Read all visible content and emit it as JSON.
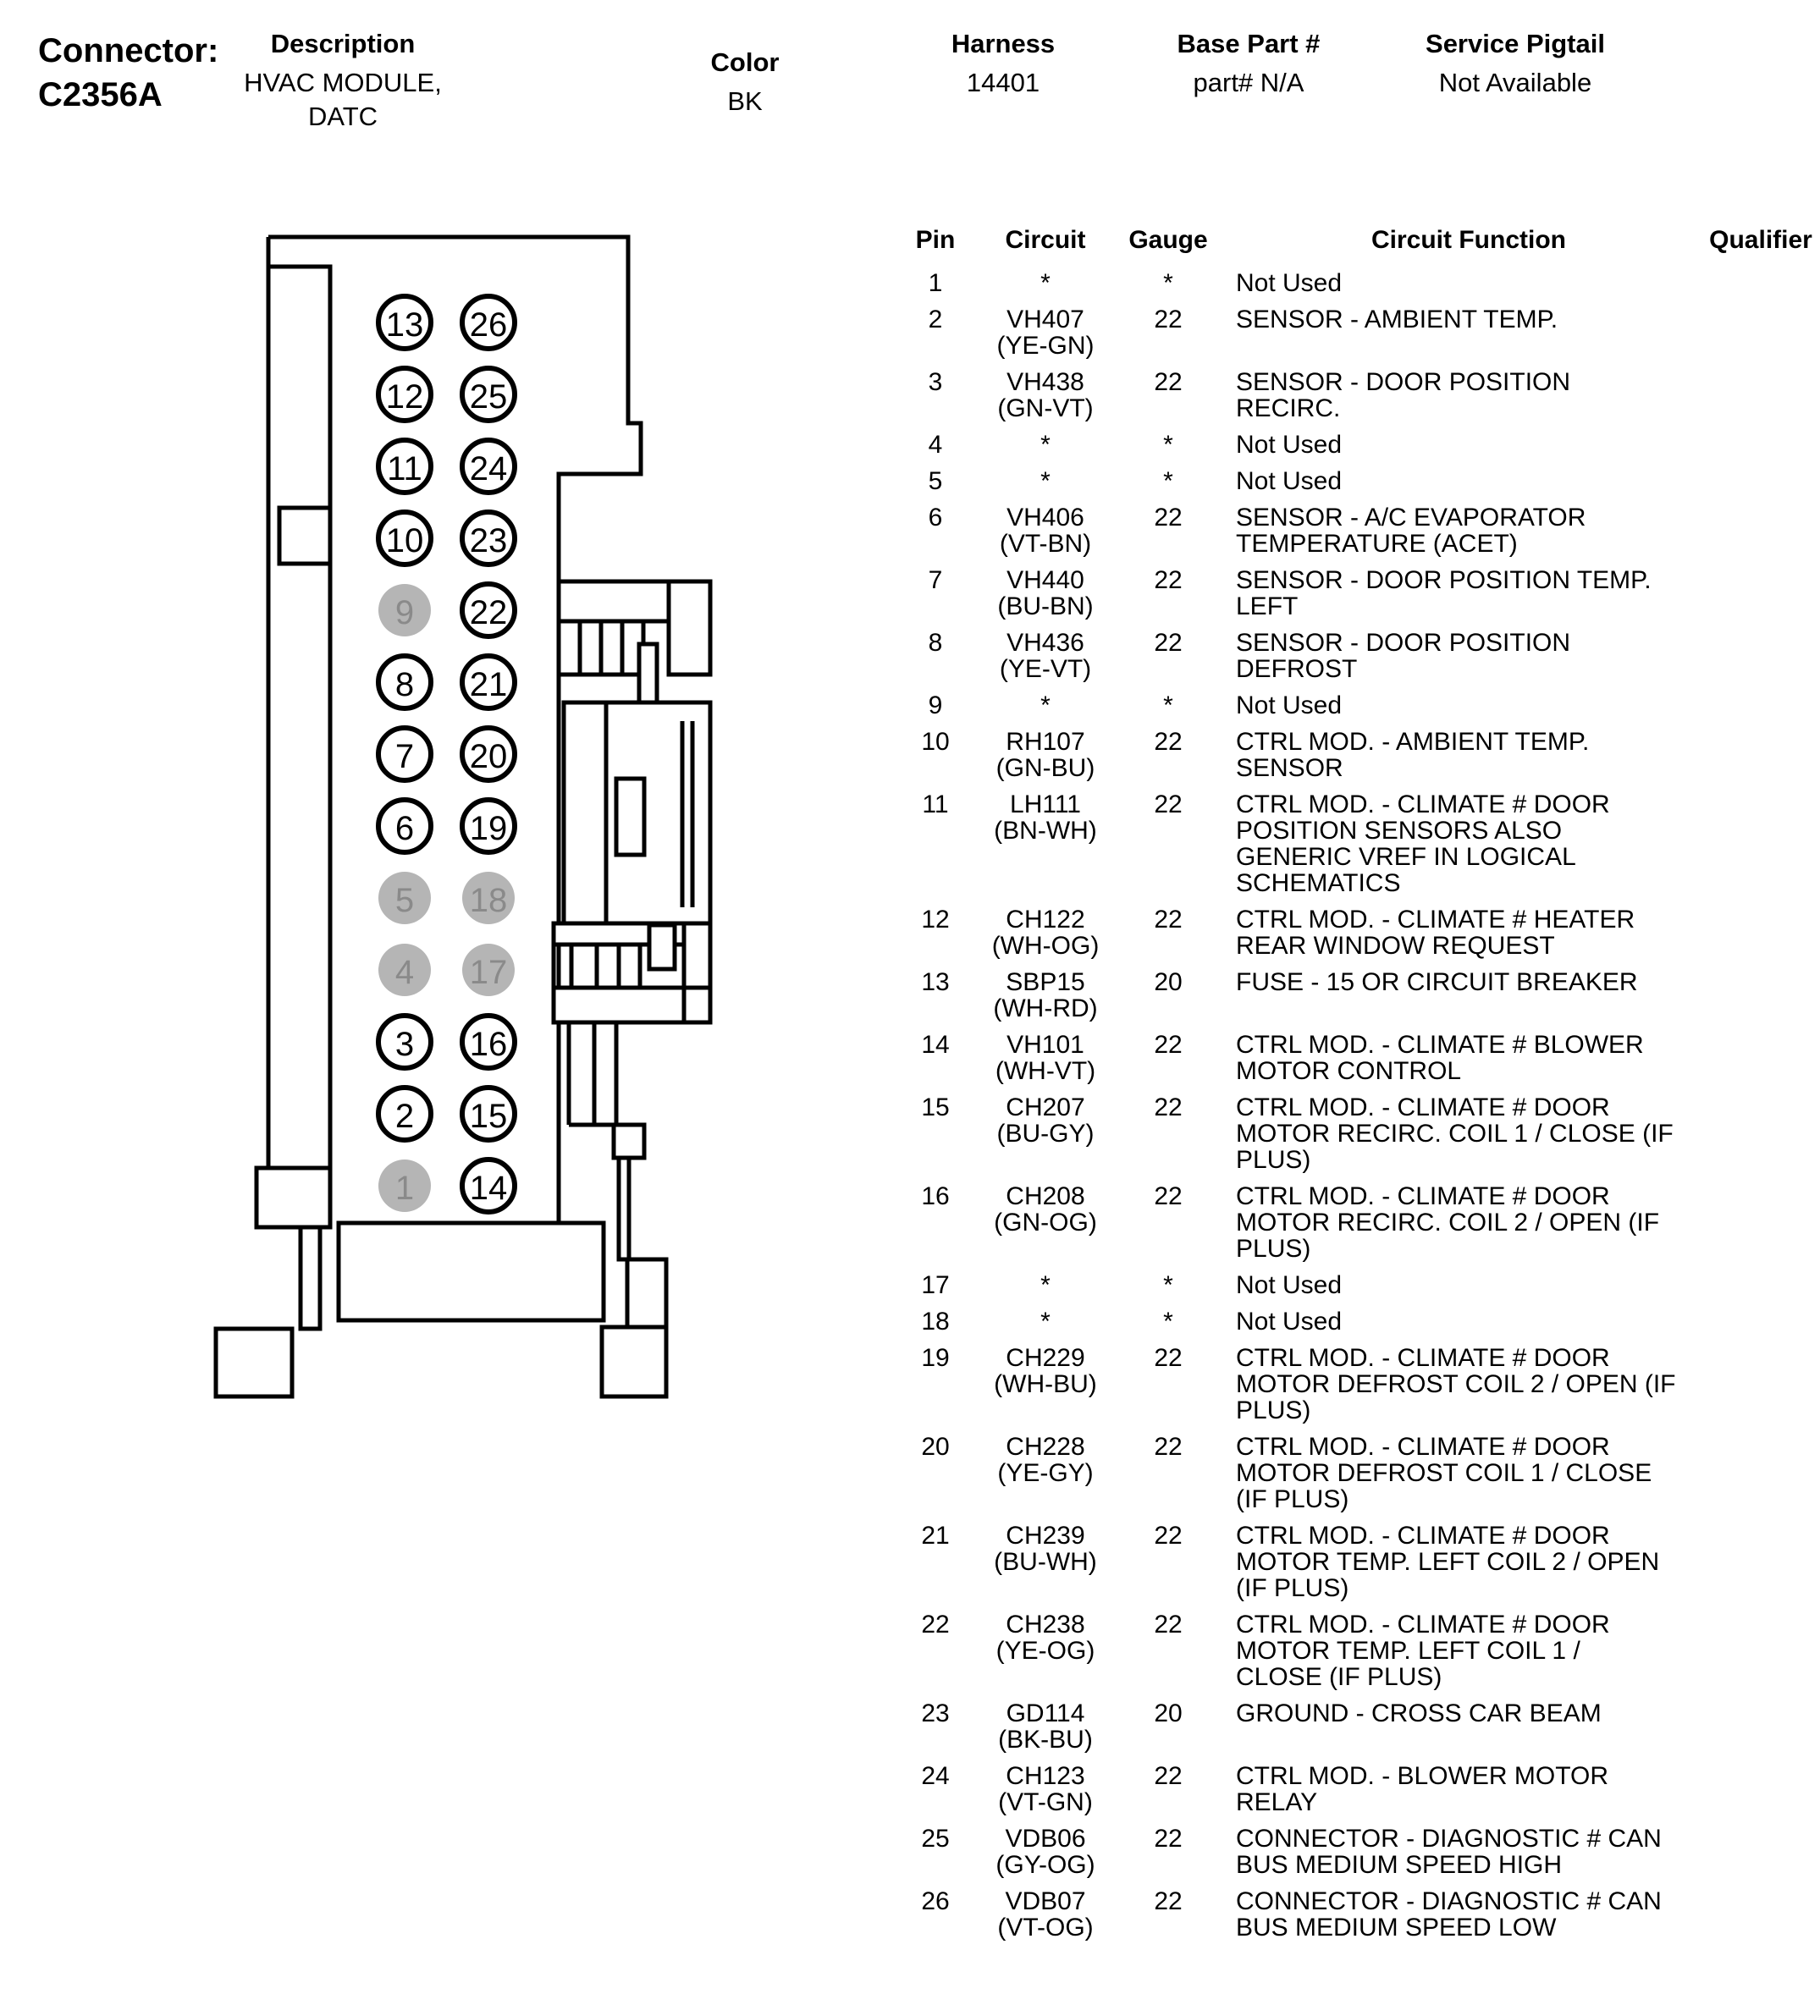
{
  "header": {
    "connector_label": "Connector:",
    "connector_id": "C2356A",
    "fields": [
      {
        "label": "Description",
        "value": "HVAC MODULE,\nDATC"
      },
      {
        "label": "Color",
        "value": "BK"
      },
      {
        "label": "Harness",
        "value": "14401"
      },
      {
        "label": "Base Part #",
        "value": "part# N/A"
      },
      {
        "label": "Service Pigtail",
        "value": "Not Available"
      }
    ]
  },
  "connector_diagram": {
    "left_column_pins_top_to_bottom": [
      13,
      12,
      11,
      10,
      9,
      8,
      7,
      6,
      5,
      4,
      3,
      2,
      1
    ],
    "right_column_pins_top_to_bottom": [
      26,
      25,
      24,
      23,
      22,
      21,
      20,
      19,
      18,
      17,
      16,
      15,
      14
    ],
    "unused_pins": [
      1,
      4,
      5,
      9,
      17,
      18
    ],
    "colors": {
      "line": "#000000",
      "unused_fill": "#b5b5b5",
      "unused_text": "#8a8a8a",
      "used_text": "#000000"
    }
  },
  "pin_table": {
    "headers": {
      "pin": "Pin",
      "circuit": "Circuit",
      "gauge": "Gauge",
      "function": "Circuit Function",
      "qualifier": "Qualifier"
    },
    "rows": [
      {
        "pin": "1",
        "circuit": "*",
        "color": "",
        "gauge": "*",
        "function": "Not Used",
        "qualifier": ""
      },
      {
        "pin": "2",
        "circuit": "VH407",
        "color": "(YE-GN)",
        "gauge": "22",
        "function": "SENSOR - AMBIENT TEMP.",
        "qualifier": ""
      },
      {
        "pin": "3",
        "circuit": "VH438",
        "color": "(GN-VT)",
        "gauge": "22",
        "function": "SENSOR - DOOR POSITION\nRECIRC.",
        "qualifier": ""
      },
      {
        "pin": "4",
        "circuit": "*",
        "color": "",
        "gauge": "*",
        "function": "Not Used",
        "qualifier": ""
      },
      {
        "pin": "5",
        "circuit": "*",
        "color": "",
        "gauge": "*",
        "function": "Not Used",
        "qualifier": ""
      },
      {
        "pin": "6",
        "circuit": "VH406",
        "color": "(VT-BN)",
        "gauge": "22",
        "function": "SENSOR - A/C EVAPORATOR\nTEMPERATURE (ACET)",
        "qualifier": ""
      },
      {
        "pin": "7",
        "circuit": "VH440",
        "color": "(BU-BN)",
        "gauge": "22",
        "function": "SENSOR - DOOR POSITION TEMP.\nLEFT",
        "qualifier": ""
      },
      {
        "pin": "8",
        "circuit": "VH436",
        "color": "(YE-VT)",
        "gauge": "22",
        "function": "SENSOR - DOOR POSITION\nDEFROST",
        "qualifier": ""
      },
      {
        "pin": "9",
        "circuit": "*",
        "color": "",
        "gauge": "*",
        "function": "Not Used",
        "qualifier": ""
      },
      {
        "pin": "10",
        "circuit": "RH107",
        "color": "(GN-BU)",
        "gauge": "22",
        "function": "CTRL MOD. - AMBIENT TEMP.\nSENSOR",
        "qualifier": ""
      },
      {
        "pin": "11",
        "circuit": "LH111",
        "color": "(BN-WH)",
        "gauge": "22",
        "function": "CTRL MOD. - CLIMATE # DOOR\nPOSITION SENSORS ALSO\nGENERIC VREF IN LOGICAL\nSCHEMATICS",
        "qualifier": ""
      },
      {
        "pin": "12",
        "circuit": "CH122",
        "color": "(WH-OG)",
        "gauge": "22",
        "function": "CTRL MOD. - CLIMATE # HEATER\nREAR WINDOW REQUEST",
        "qualifier": ""
      },
      {
        "pin": "13",
        "circuit": "SBP15",
        "color": "(WH-RD)",
        "gauge": "20",
        "function": "FUSE - 15 OR CIRCUIT BREAKER",
        "qualifier": ""
      },
      {
        "pin": "14",
        "circuit": "VH101",
        "color": "(WH-VT)",
        "gauge": "22",
        "function": "CTRL MOD. - CLIMATE # BLOWER\nMOTOR CONTROL",
        "qualifier": ""
      },
      {
        "pin": "15",
        "circuit": "CH207",
        "color": "(BU-GY)",
        "gauge": "22",
        "function": "CTRL MOD. - CLIMATE # DOOR\nMOTOR RECIRC. COIL 1 / CLOSE (IF\nPLUS)",
        "qualifier": ""
      },
      {
        "pin": "16",
        "circuit": "CH208",
        "color": "(GN-OG)",
        "gauge": "22",
        "function": "CTRL MOD. - CLIMATE # DOOR\nMOTOR RECIRC. COIL 2 / OPEN (IF\nPLUS)",
        "qualifier": ""
      },
      {
        "pin": "17",
        "circuit": "*",
        "color": "",
        "gauge": "*",
        "function": "Not Used",
        "qualifier": ""
      },
      {
        "pin": "18",
        "circuit": "*",
        "color": "",
        "gauge": "*",
        "function": "Not Used",
        "qualifier": ""
      },
      {
        "pin": "19",
        "circuit": "CH229",
        "color": "(WH-BU)",
        "gauge": "22",
        "function": "CTRL MOD. - CLIMATE # DOOR\nMOTOR DEFROST COIL 2 / OPEN (IF\nPLUS)",
        "qualifier": ""
      },
      {
        "pin": "20",
        "circuit": "CH228",
        "color": "(YE-GY)",
        "gauge": "22",
        "function": "CTRL MOD. - CLIMATE # DOOR\nMOTOR DEFROST COIL 1 / CLOSE\n(IF PLUS)",
        "qualifier": ""
      },
      {
        "pin": "21",
        "circuit": "CH239",
        "color": "(BU-WH)",
        "gauge": "22",
        "function": "CTRL MOD. - CLIMATE # DOOR\nMOTOR TEMP. LEFT COIL 2 / OPEN\n(IF PLUS)",
        "qualifier": ""
      },
      {
        "pin": "22",
        "circuit": "CH238",
        "color": "(YE-OG)",
        "gauge": "22",
        "function": "CTRL MOD. - CLIMATE # DOOR\nMOTOR TEMP. LEFT COIL 1 /\nCLOSE (IF PLUS)",
        "qualifier": ""
      },
      {
        "pin": "23",
        "circuit": "GD114",
        "color": "(BK-BU)",
        "gauge": "20",
        "function": "GROUND - CROSS CAR BEAM",
        "qualifier": ""
      },
      {
        "pin": "24",
        "circuit": "CH123",
        "color": "(VT-GN)",
        "gauge": "22",
        "function": "CTRL MOD. - BLOWER MOTOR\nRELAY",
        "qualifier": ""
      },
      {
        "pin": "25",
        "circuit": "VDB06",
        "color": "(GY-OG)",
        "gauge": "22",
        "function": "CONNECTOR - DIAGNOSTIC # CAN\nBUS MEDIUM SPEED HIGH",
        "qualifier": ""
      },
      {
        "pin": "26",
        "circuit": "VDB07",
        "color": "(VT-OG)",
        "gauge": "22",
        "function": "CONNECTOR - DIAGNOSTIC # CAN\nBUS MEDIUM SPEED LOW",
        "qualifier": ""
      }
    ]
  }
}
